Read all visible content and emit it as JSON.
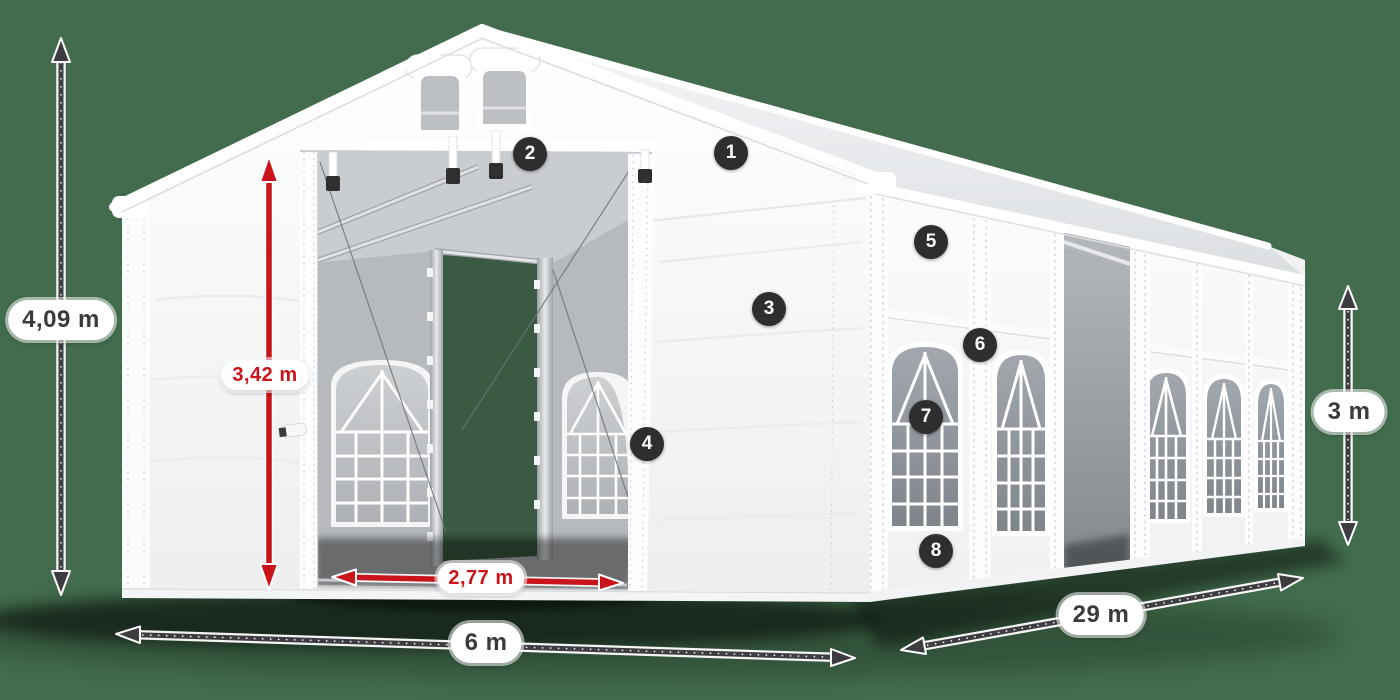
{
  "scene": {
    "background_color": "#426C4D",
    "subject": "white marquee tent product illustration"
  },
  "dimension_labels": {
    "total_height": "4,09 m",
    "entrance_height": "3,42 m",
    "entrance_width": "2,77 m",
    "front_width": "6 m",
    "side_length": "29 m",
    "wall_height": "3 m"
  },
  "callout_badges": [
    {
      "number": "1"
    },
    {
      "number": "2"
    },
    {
      "number": "3"
    },
    {
      "number": "4"
    },
    {
      "number": "5"
    },
    {
      "number": "6"
    },
    {
      "number": "7"
    },
    {
      "number": "8"
    }
  ],
  "colors": {
    "background_green": "#426C4D",
    "dimension_arrow_dark": "#3D3D41",
    "dimension_arrow_red": "#C8141A",
    "badge_background": "#2E2E31",
    "label_text_dark": "#3A3A3E",
    "tent_white": "#FFFFFF",
    "glass_gray": "#8F959B"
  }
}
